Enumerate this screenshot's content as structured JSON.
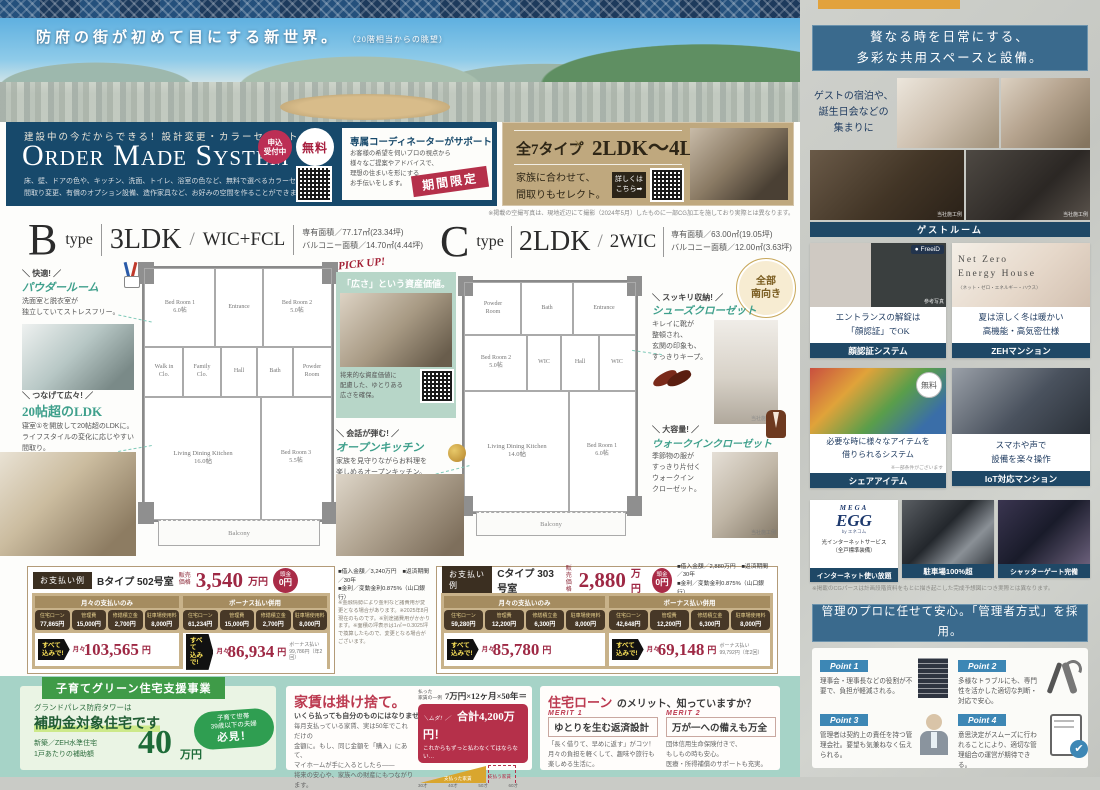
{
  "hero": {
    "headline": "防府の街が初めて目にする新世界。",
    "note": "（20階相当からの眺望）"
  },
  "omd": {
    "kicker": "建設中の今だからできる！設計変更・カラーセレクト",
    "title": "Order Made System",
    "badge_accept": "申込\n受付中",
    "badge_free": "無料",
    "body": "床、壁、ドアの色や、キッチン、洗面、トイレ、浴室の色など、無料で選べるカラーセレクトや\n間取り変更、有償のオプション設備、造作家具など、お好みの空間を作ることができます。",
    "co_title": "専属コーディネーターがサポート",
    "co_body": "お客様の希望を伺いプロの視点から\n様々なご提案やアドバイスで、\n理想の住まいを形にする\nお手伝いをします。",
    "stamp": "期間限定",
    "t_left": "全7タイプ",
    "t_x": "×",
    "t_right": "2LDK〜4LDK",
    "t_caption": "家族に合わせて、\n間取りもセレクト。",
    "link": "詳しくは\nこちら➡",
    "note": "※掲載の空撮写真は、現地近辺にて撮影（2024年5月）したものに一部CG加工を施しており実際とは異なります。"
  },
  "bhead": {
    "letter": "B",
    "word": "type",
    "plan": "3LDK",
    "sep": "/",
    "opt": "WIC+FCL",
    "a1": "専有面積／77.17㎡(23.34坪)",
    "a2": "バルコニー面積／14.70㎡(4.44坪)"
  },
  "chead": {
    "letter": "C",
    "word": "type",
    "plan": "2LDK",
    "sep": "/",
    "opt": "2WIC",
    "a1": "専有面積／63.00㎡(19.05坪)",
    "a2": "バルコニー面積／12.00㎡(3.63坪)"
  },
  "planb": {
    "br1": "Bed Room 1\n6.0帖",
    "ent": "Entrance",
    "br2": "Bed Room 2\n5.0帖",
    "wic": "Walk in\nClo.",
    "fcl": "Family\nClo.",
    "hall": "Hall",
    "bath": "Bath",
    "pow": "Powder\nRoom",
    "ldk": "Living Dining Kitchen\n16.0帖",
    "br3": "Bed Room 3\n5.5帖",
    "balc": "Balcony"
  },
  "planc": {
    "pow": "Powder\nRoom",
    "bath": "Bath",
    "ent": "Entrance",
    "br2": "Bed Room 2\n5.0帖",
    "wic1": "WIC",
    "hall": "Hall",
    "wic2": "WIC",
    "ldk": "Living Dining Kitchen\n14.0帖",
    "br1": "Bed Room 1\n6.0帖",
    "balc": "Balcony"
  },
  "an_powder": {
    "flag": "＼ 快適! ／",
    "title": "パウダールーム",
    "body": "洗面室と脱衣室が\n独立していてストレスフリー。"
  },
  "an_ldk": {
    "flag": "＼ つなげて広々! ／",
    "title": "20帖超のLDK",
    "body": "寝室①を開放して20帖超のLDKに。\nライフスタイルの変化に応じやすい\n間取り。"
  },
  "pickup": {
    "kicker": "PICK UP!",
    "title": "「広さ」という資産価値。",
    "body": "将来的な資産価値に\n配慮した、ゆとりある\n広さを確保。"
  },
  "an_kitchen": {
    "flag": "＼ 会話が弾む! ／",
    "title": "オープンキッチン",
    "body": "家族を見守りながらお料理を\n楽しめるオープンキッチン。"
  },
  "south_badge": "全部\n南向き",
  "an_shoes": {
    "flag": "＼ スッキリ収納! ／",
    "title": "シューズクローゼット",
    "body": "キレイに靴が\n整頓され、\n玄関の印象も、\nすっきりキープ。",
    "note": "当社施工例"
  },
  "an_wic": {
    "flag": "＼ 大容量! ／",
    "title": "ウォークインクローゼット",
    "body": "季節物の服が\nすっきり片付く\nウォークイン\nクローゼット。",
    "note": "当社施工例"
  },
  "payb": {
    "label": "お支払い例",
    "unit": "Bタイプ 502号室",
    "price_label": "販売\n価格",
    "price": "3,540",
    "price_unit": "万円",
    "down1": "頭金",
    "down2": "0円",
    "terms": "■借入金額／3,240万円　■返済期間／30年\n■金利／変動金利0.875%（山口銀行）",
    "c1": {
      "header": "月々の支払いのみ",
      "l1": "住宅ローン",
      "v1": "77,865円",
      "l2": "管理費",
      "v2": "15,000円",
      "l3": "修繕積立金",
      "v3": "2,700円",
      "l4": "駐車場使用料",
      "v4": "8,000円",
      "all": "すべて\n込みで!",
      "per": "月々",
      "total": "103,565",
      "yen": "円"
    },
    "c2": {
      "header": "ボーナス払い併用",
      "l1": "住宅ローン",
      "v1": "61,234円",
      "l2": "管理費",
      "v2": "15,000円",
      "l3": "修繕積立金",
      "v3": "2,700円",
      "l4": "駐車場使用料",
      "v4": "8,000円",
      "all": "すべて\n込みで!",
      "per": "月々",
      "total": "86,934",
      "yen": "円",
      "bonus": "ボーナス払い\n99,786円（年2回）"
    }
  },
  "pay_notes": "※金融情勢により金利など諸費用が変更となる場合があります。※2025年8月現在のものです。※別途諸費用がかかります。※面積の坪表示は1㎡＝0.3025坪で換算したもので、変更となる場合がございます。",
  "payc": {
    "label": "お支払い例",
    "unit": "Cタイプ 303号室",
    "price_label": "販売\n価格",
    "price": "2,880",
    "price_unit": "万円",
    "down1": "頭金",
    "down2": "0円",
    "terms": "■借入金額／2,880万円　■返済期間／30年\n■金利／変動金利0.875%（山口銀行）",
    "c1": {
      "header": "月々の支払いのみ",
      "l1": "住宅ローン",
      "v1": "59,280円",
      "l2": "管理費",
      "v2": "12,200円",
      "l3": "修繕積立金",
      "v3": "6,300円",
      "l4": "駐車場使用料",
      "v4": "8,000円",
      "all": "すべて\n込みで!",
      "per": "月々",
      "total": "85,780",
      "yen": "円"
    },
    "c2": {
      "header": "ボーナス払い併用",
      "l1": "住宅ローン",
      "v1": "42,648円",
      "l2": "管理費",
      "v2": "12,200円",
      "l3": "修繕積立金",
      "v3": "6,300円",
      "l4": "駐車場使用料",
      "v4": "8,000円",
      "all": "すべて\n込みで!",
      "per": "月々",
      "total": "69,148",
      "yen": "円",
      "bonus": "ボーナス払い\n99,792円（年2回）"
    }
  },
  "support": {
    "banner": "子育てグリーン住宅支援事業",
    "line1": "グランドパレス防府タワーは",
    "line2": "補助金対象住宅です",
    "spec": "新築／ZEH水準住宅\n1戸あたりの補助額",
    "amount": "40",
    "unit": "万円",
    "bubble": "子育て世帯\n39歳以下の夫婦",
    "bubble_em": "必見！"
  },
  "rent": {
    "title": "家賃は掛け捨て。",
    "subtitle": "いくら払っても自分のものにはなりません。",
    "body": "毎月支払っている家賃、実は50年でこれだけの\n金額に。もし、同じ金額を「購入」にあて、\nマイホームが手に入るとしたら――\n将来の安心や、家族への財産にもつながります。",
    "example_label": "払った\n家賃の一例",
    "formula": "7万円×12ヶ月×50年＝",
    "muda": "＼ムダ！／",
    "total": "合計4,200万円！",
    "total_note": "これからもずっと払わなくてはならない…",
    "paid": "支払った家賃",
    "future": "支払う家賃",
    "t0": "30才",
    "t1": "40才",
    "t2": "50才",
    "t3": "60才"
  },
  "merit": {
    "em": "住宅ローン",
    "rest": "のメリット、知っていますか？",
    "m1_label": "MERIT 1",
    "m1_title": "ゆとりを生む返済設計",
    "m1_body": "「長く借りて、早めに返す」がコツ！\n月々の負担を軽くして、趣味や旅行も\n楽しめる生活に。",
    "m2_label": "MERIT 2",
    "m2_title": "万が一への備えも万全",
    "m2_body": "団体信用生命保険付きで、\nもしもの時も安心。\n医療・所得補償のサポートも充実。"
  },
  "shared": {
    "header": "贅なる時を日常にする、\n多彩な共用スペースと設備。",
    "guest_lead": "ゲストの宿泊や、\n誕生日会などの\n集まりに",
    "guest_caption": "ゲストルーム",
    "koji": "当社施工例",
    "face_logo": "● FreeiD",
    "face_text": "エントランスの解錠は\n「顔認証」でOK",
    "face_caption": "顔認証システム",
    "face_note": "参考写真",
    "zeh_logo": "Net Zero\nEnergy House",
    "zeh_sub": "〈ネット・ゼロ・エネルギー・ハウス〉",
    "zeh_text": "夏は涼しく冬は暖かい\n高機能・高気密仕様",
    "zeh_caption": "ZEHマンション",
    "share_badge": "無料",
    "share_text": "必要な時に様々なアイテムを\n借りられるシステム",
    "share_note": "※一部条件がございます",
    "share_caption": "シェアアイテム",
    "iot_text": "スマホや声で\n設備を楽々操作",
    "iot_caption": "IoT対応マンション",
    "net_logo1": "MEGA",
    "net_logo2": "EGG",
    "net_sub": "by エネコム",
    "net_text": "光インターネットサービス\n（全戸標準装備）",
    "net_caption": "インターネット使い放題",
    "parking_caption": "駐車場100%超",
    "gate_caption": "シャッターゲート完備",
    "cg_note": "※掲載のCGパースは計画段階資料をもとに描き起こした完成予想図につき実際とは異なります。"
  },
  "mgmt": {
    "header": "管理のプロに任せて安心。「管理者方式」を採用。",
    "p1_label": "Point 1",
    "p1_body": "理事会・理事長などの役割が不要で、負担が軽減される。",
    "p2_label": "Point 2",
    "p2_body": "多様なトラブルにも、専門性を活かした適切な判断・対応で安心。",
    "p3_label": "Point 3",
    "p3_body": "管理者は契約上の責任を持つ管理会社。要望も気兼ねなく伝えられる。",
    "p4_label": "Point 4",
    "p4_body": "意思決定がスムーズに行われることにより、適切な管理組合の運営が期待できる。"
  }
}
